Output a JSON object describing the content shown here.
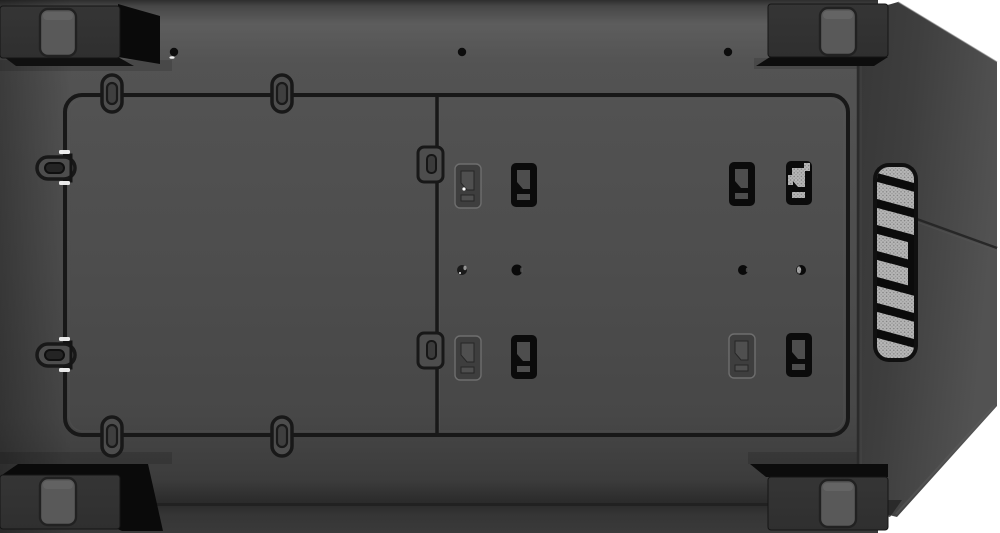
{
  "scene": {
    "type": "product-photo",
    "subject": "computer-case-bottom-panel-view",
    "description": "Bottom exterior of a black mid-tower PC case: four corner feet with rubber pads, recessed dust-filter frame with pull tabs, stamped mounting clips, screw holes, angled front bezel with meshed vent strip",
    "background": "#ffffff"
  },
  "colors": {
    "bg": "#ffffff",
    "panel": "#4d4d4d",
    "panel_light": "#5d5d5d",
    "panel_dark": "#2e2e2e",
    "seam": "#181818",
    "bezel_dark": "#373737",
    "bezel_light": "#525252",
    "foot_face": "#2f2f2f",
    "foot_side": "#0a0a0a",
    "pad": "#595959",
    "mesh_base": "#b7b7b7",
    "mesh_dot": "#808080",
    "slat": "#0b0b0b",
    "glint": "#ffffff"
  },
  "parts": {
    "feet": {
      "count": 4,
      "positions": [
        "top-left",
        "top-right",
        "bottom-left",
        "bottom-right"
      ],
      "pad_per_foot": 1
    },
    "filter_frame": {
      "pull_tab_pills": 4,
      "side_latches": 2,
      "divider_tabs": 2
    },
    "mounting_clips": {
      "count": 8,
      "rows": 2,
      "per_row": 4
    },
    "screw_holes": {
      "top_row": 3,
      "middle_row": 4
    },
    "vent": {
      "slat_count": 7,
      "shape": "rounded-vertical-strip"
    }
  }
}
